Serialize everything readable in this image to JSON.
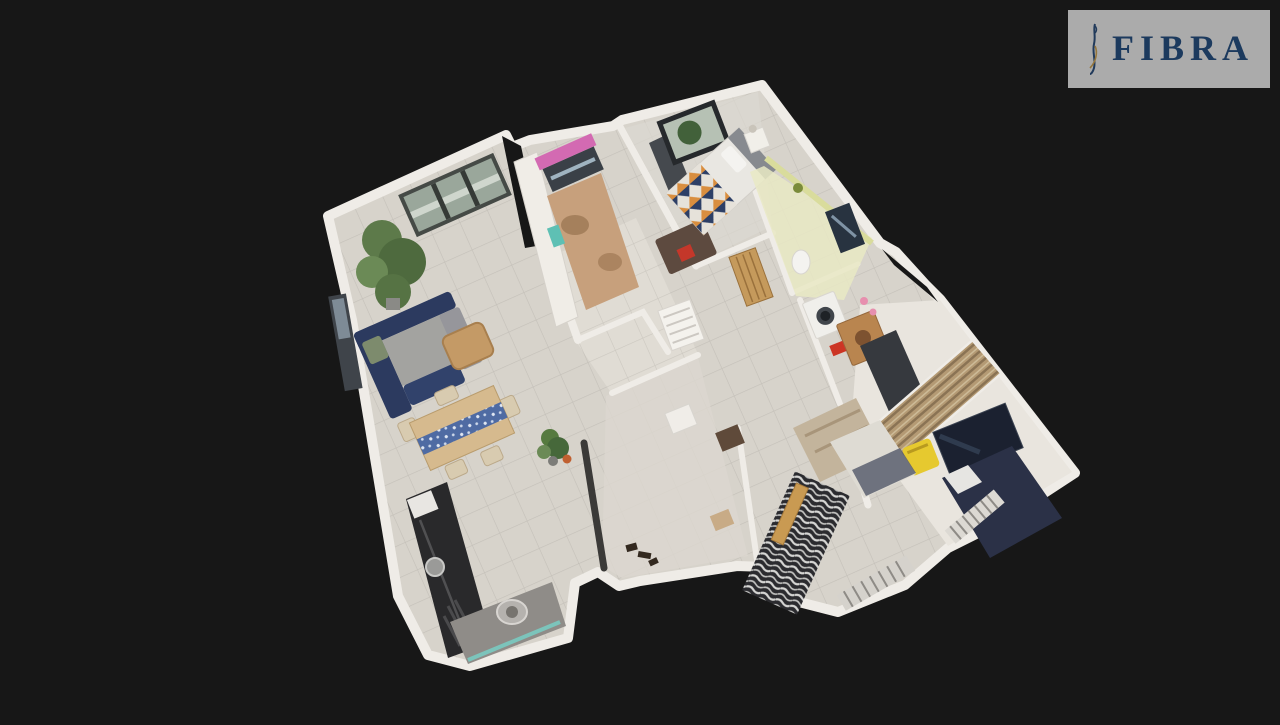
{
  "app": {
    "name": "3d-virtual-tour-viewer",
    "view_mode": "dollhouse-floor-plan",
    "background": "#171717"
  },
  "watermark": {
    "brand": "FIBRA",
    "panel_color": "#b0b0b0",
    "text_color": "#1d3c61"
  },
  "scene": {
    "type": "apartment-3d-cutaway-model",
    "rooms": [
      "living-room",
      "kitchen",
      "bedroom-1",
      "bathroom",
      "laundry-bathroom",
      "hallway",
      "entry-hall",
      "bedroom-2",
      "bedroom-3"
    ],
    "palette": {
      "wall": "#efece7",
      "floor_tile": "#d7d3cb",
      "sofa_navy": "#2c3a5f",
      "bed_blanket_navy": "#2d3f66",
      "bed_blanket_orange": "#d98e3f",
      "kitchen_window_pink": "#d36ab2",
      "bath_wall_yellow": "#e9e9c4",
      "chair_yellow": "#e6c92f",
      "counter_teal": "#7cc4bb",
      "wood": "#c59a5c",
      "dark_bed_cover": "#2b3147",
      "zebra_rug_dark": "#2b2b2f"
    }
  }
}
